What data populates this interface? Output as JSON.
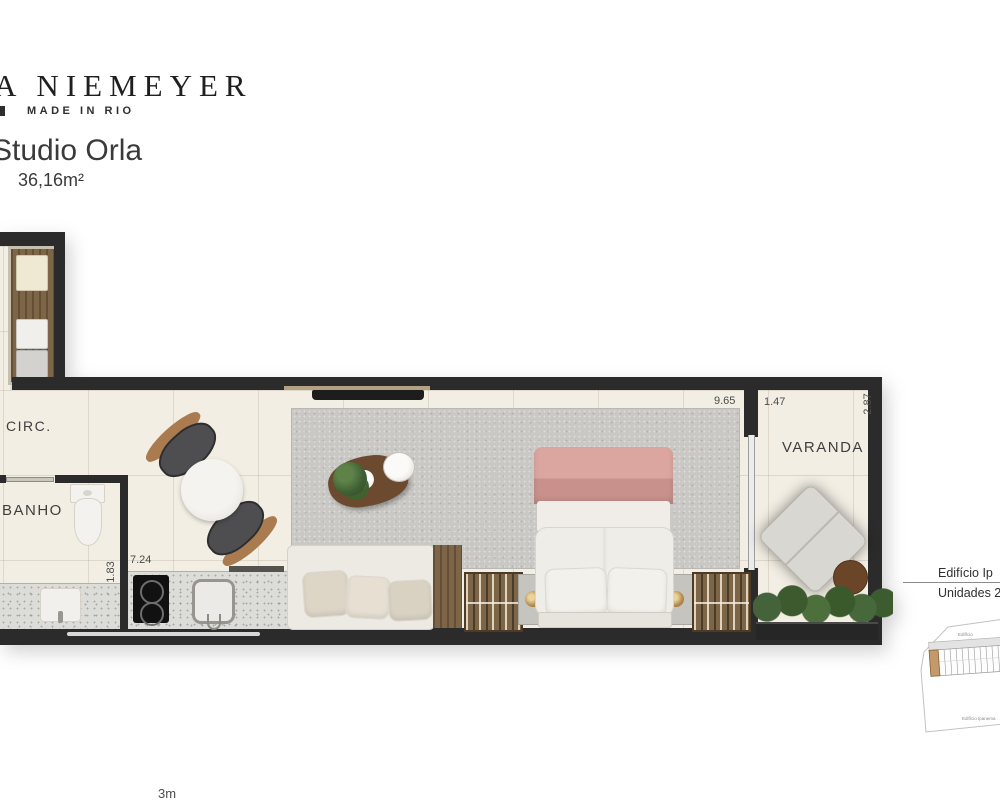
{
  "header": {
    "brand": "A NIEMEYER",
    "tagline": "MADE IN RIO",
    "title": "Studio Orla",
    "area": "36,16m²"
  },
  "plan": {
    "rooms": {
      "circ": "CIRC.",
      "banho": "BANHO",
      "studio": "STUDIO",
      "varanda": "VARANDA"
    },
    "dimensions": {
      "kitchen_length": "7.24",
      "bath_width": "1.83",
      "studio_length": "9.65",
      "varanda_width": "1.47",
      "varanda_depth": "2.87"
    },
    "scale_label": "3m"
  },
  "key_plan": {
    "building": "Edifício Ip",
    "units": "Unidades 2",
    "map_label_top": "Edifício",
    "map_label_bottom": "Edifício Ipanema"
  },
  "colors": {
    "wall": "#2b2b2b",
    "floor": "#f2eee4",
    "rug": "#c9c8c5",
    "accent_pink": "#d69e98",
    "wood": "#7d6548",
    "unit_highlight": "#c49a6c"
  }
}
